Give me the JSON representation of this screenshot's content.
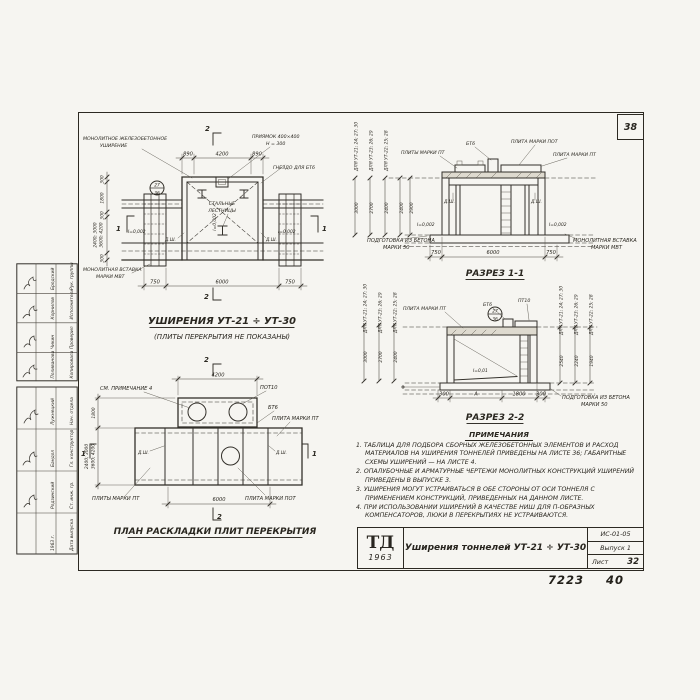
{
  "sheet": {
    "corner_number": "38",
    "stamp_number": "7223",
    "stamp_number2": "40"
  },
  "plan": {
    "section_mark_v": "2",
    "section_mark_h": "1",
    "labels": {
      "widening1": "Монолитное железобетонное",
      "widening2": "уширение",
      "pit1": "Приямок 400×400",
      "pit2": "h = 300",
      "socket": "Гнездо для БТ6",
      "ladders1": "Стальные",
      "ladders2": "лестницы",
      "insert1": "Монолитная вставка",
      "insert2": "марки МВТ",
      "joint": "Д.ш.",
      "slope": "i=0,002",
      "detail_top": "27",
      "detail_bottom": "36"
    },
    "dims": {
      "top": [
        "890",
        "4200",
        "890"
      ],
      "bottom": [
        "750",
        "6000",
        "750"
      ],
      "left": [
        "300",
        "1800",
        "300",
        "2400; 3000",
        "3600; 4200",
        "300"
      ]
    },
    "title": "Уширения УТ-21 ÷ УТ-30",
    "subtitle": "(Плиты перекрытия не показаны)"
  },
  "section1": {
    "title": "Разрез 1-1",
    "labels": {
      "plates_pt": "Плиты марки ПТ",
      "bt6": "БТ6",
      "plate_pot": "Плита марки ПОТ",
      "plate_pt": "Плита марки ПТ",
      "insert1": "Монолитная вставка",
      "insert2": "марки МВТ",
      "prep1": "Подготовка из бетона",
      "prep2": "марки 50",
      "joint": "Д.ш.",
      "slope": "i=0,002"
    },
    "dims": {
      "bottom": [
        "750",
        "6000",
        "750"
      ],
      "inner": [
        "2400",
        "2900"
      ],
      "variants": [
        {
          "label": "Для УТ-21; 24; 27; 30",
          "value": "3000"
        },
        {
          "label": "Для УТ-23; 26; 29",
          "value": "2700"
        },
        {
          "label": "Для УТ-22; 25; 28",
          "value": "2400"
        }
      ]
    }
  },
  "section2": {
    "title": "Разрез 2-2",
    "labels": {
      "plate_pt": "Плита марки ПТ",
      "bt6": "БТ6",
      "pt10": "ПТ10",
      "prep1": "Подготовка из бетона",
      "prep2": "марки 50",
      "slope": "i=0,01",
      "detail_top": "27",
      "detail_bottom": "36"
    },
    "dims": {
      "bottom": [
        "300",
        "А",
        "1800",
        "300"
      ],
      "left": [
        {
          "label": "Для УТ-21; 24; 27; 30",
          "value": "3000"
        },
        {
          "label": "Для УТ-23; 26; 29",
          "value": "2700"
        },
        {
          "label": "Для УТ-22; 25; 28",
          "value": "2400"
        }
      ],
      "right": [
        {
          "label": "Для УТ-21; 24; 27; 30",
          "value": "2540"
        },
        {
          "label": "Для УТ-23; 26; 29",
          "value": "2240"
        },
        {
          "label": "Для УТ-22; 25; 28",
          "value": "1940"
        }
      ]
    }
  },
  "plates_plan": {
    "title": "План раскладки плит перекрытия",
    "section_mark_v": "2",
    "section_mark_h": "1",
    "labels": {
      "see_note": "См. примечание 4",
      "pot10": "ПОТ10",
      "bt6": "БТ6",
      "plate_pt": "Плита марки ПТ",
      "plates_pt": "Плиты марки ПТ",
      "plate_pot": "Плита марки ПОТ",
      "joint": "Д.ш."
    },
    "dims": {
      "top": "4200",
      "bottom": "6000",
      "left_upper": "1800",
      "left_var1": "2400; 3000",
      "left_var2": "3600; 4200"
    }
  },
  "notes": {
    "title": "Примечания",
    "items": [
      "1. Таблица для подбора сборных железобетонных элементов и расход материалов на уширения тоннелей приведены на листе 36; габаритные схемы уширений — на листе 4.",
      "2. Опалубочные и арматурные чертежи монолитных конструкций уширений приведены в выпуске 3.",
      "3. Уширения могут устраиваться в обе стороны от оси тоннеля с применением конструкций, приведенных на данном листе.",
      "4. При использовании уширений в качестве ниш для П-образных компенсаторов, люки в перекрытиях не устраиваются."
    ]
  },
  "titleblock": {
    "logo": "ТД",
    "logo_year": "1963",
    "title": "Уширения тоннелей УТ-21 ÷ УТ-30",
    "code": "ИС-01-05",
    "issue": "Выпуск 1",
    "sheet_label": "Лист",
    "sheet_number": "32"
  },
  "stamp": {
    "upper": [
      {
        "role": "Рук. группы",
        "name": "Бродский"
      },
      {
        "role": "Исполнитель",
        "name": "Корнилов"
      },
      {
        "role": "Проверил",
        "name": "Чикин"
      },
      {
        "role": "Копировала",
        "name": "Поливанова"
      }
    ],
    "lower": [
      {
        "role": "Нач. отдела",
        "name": "Лужнецкий"
      },
      {
        "role": "Гл. конструктор",
        "name": "Бандол"
      },
      {
        "role": "Ст. инж. гр.",
        "name": "Родзинский"
      },
      {
        "role": "Дата выпуска",
        "name": "1963 г."
      }
    ]
  }
}
